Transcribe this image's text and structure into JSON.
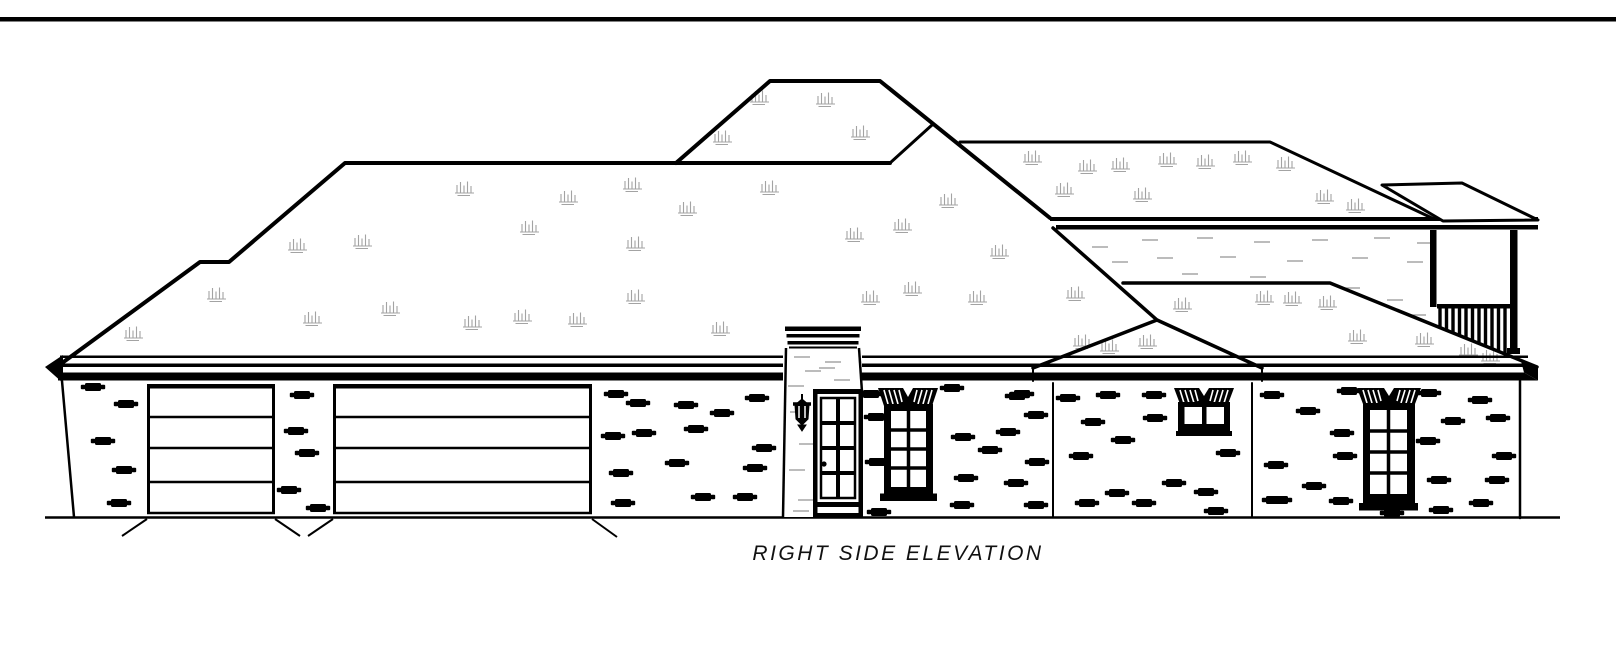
{
  "title": {
    "text": "RIGHT SIDE ELEVATION"
  },
  "colors": {
    "line": "#000000",
    "roof_texture": "#a3a3a3",
    "stucco": "#8f8f8f",
    "paper": "#ffffff"
  },
  "drawing": {
    "kind": "architectural side elevation, black ink on white",
    "roof_texture_marks": [
      [
        133,
        333
      ],
      [
        216,
        294
      ],
      [
        297,
        245
      ],
      [
        362,
        241
      ],
      [
        312,
        318
      ],
      [
        390,
        308
      ],
      [
        464,
        188
      ],
      [
        472,
        322
      ],
      [
        522,
        316
      ],
      [
        529,
        227
      ],
      [
        568,
        197
      ],
      [
        577,
        319
      ],
      [
        632,
        184
      ],
      [
        635,
        243
      ],
      [
        635,
        296
      ],
      [
        687,
        208
      ],
      [
        720,
        328
      ],
      [
        759,
        97
      ],
      [
        769,
        187
      ],
      [
        825,
        99
      ],
      [
        722,
        137
      ],
      [
        860,
        132
      ],
      [
        854,
        234
      ],
      [
        870,
        297
      ],
      [
        902,
        225
      ],
      [
        912,
        288
      ],
      [
        977,
        297
      ],
      [
        999,
        251
      ],
      [
        948,
        200
      ],
      [
        1032,
        157
      ],
      [
        1087,
        166
      ],
      [
        1120,
        164
      ],
      [
        1167,
        159
      ],
      [
        1205,
        161
      ],
      [
        1242,
        157
      ],
      [
        1064,
        189
      ],
      [
        1142,
        194
      ],
      [
        1285,
        163
      ],
      [
        1324,
        196
      ],
      [
        1355,
        205
      ],
      [
        1292,
        298
      ],
      [
        1075,
        293
      ],
      [
        1182,
        304
      ],
      [
        1264,
        297
      ],
      [
        1327,
        302
      ],
      [
        1109,
        346
      ],
      [
        1147,
        341
      ],
      [
        1357,
        336
      ],
      [
        1424,
        339
      ],
      [
        1082,
        341
      ],
      [
        1468,
        350
      ],
      [
        1490,
        356
      ]
    ],
    "brick_marks": [
      [
        93,
        387
      ],
      [
        126,
        404
      ],
      [
        103,
        441
      ],
      [
        124,
        470
      ],
      [
        119,
        503
      ],
      [
        302,
        395
      ],
      [
        296,
        431
      ],
      [
        307,
        453
      ],
      [
        289,
        490
      ],
      [
        318,
        508
      ],
      [
        616,
        394
      ],
      [
        638,
        403
      ],
      [
        686,
        405
      ],
      [
        722,
        413
      ],
      [
        757,
        398
      ],
      [
        613,
        436
      ],
      [
        644,
        433
      ],
      [
        696,
        429
      ],
      [
        764,
        448
      ],
      [
        677,
        463
      ],
      [
        755,
        468
      ],
      [
        621,
        473
      ],
      [
        703,
        497
      ],
      [
        745,
        497
      ],
      [
        623,
        503
      ],
      [
        871,
        394
      ],
      [
        876,
        417
      ],
      [
        877,
        462
      ],
      [
        879,
        512
      ],
      [
        952,
        388
      ],
      [
        1017,
        396
      ],
      [
        963,
        437
      ],
      [
        1008,
        432
      ],
      [
        1036,
        415
      ],
      [
        966,
        478
      ],
      [
        1016,
        483
      ],
      [
        1037,
        462
      ],
      [
        962,
        505
      ],
      [
        1036,
        505
      ],
      [
        990,
        450
      ],
      [
        1022,
        394
      ],
      [
        1068,
        398
      ],
      [
        1108,
        395
      ],
      [
        1154,
        395
      ],
      [
        1093,
        422
      ],
      [
        1155,
        418
      ],
      [
        1123,
        440
      ],
      [
        1081,
        456
      ],
      [
        1228,
        453
      ],
      [
        1174,
        483
      ],
      [
        1206,
        492
      ],
      [
        1087,
        503
      ],
      [
        1117,
        493
      ],
      [
        1144,
        503
      ],
      [
        1216,
        511
      ],
      [
        1272,
        395
      ],
      [
        1276,
        465
      ],
      [
        1274,
        500
      ],
      [
        1308,
        411
      ],
      [
        1342,
        433
      ],
      [
        1345,
        456
      ],
      [
        1341,
        501
      ],
      [
        1280,
        500
      ],
      [
        1349,
        391
      ],
      [
        1314,
        486
      ],
      [
        1429,
        393
      ],
      [
        1480,
        400
      ],
      [
        1498,
        418
      ],
      [
        1453,
        421
      ],
      [
        1428,
        441
      ],
      [
        1504,
        456
      ],
      [
        1439,
        480
      ],
      [
        1497,
        480
      ],
      [
        1481,
        503
      ],
      [
        1441,
        510
      ],
      [
        1392,
        513
      ]
    ],
    "stucco_marks_upper_wall": [
      [
        1100,
        247
      ],
      [
        1150,
        240
      ],
      [
        1205,
        238
      ],
      [
        1262,
        242
      ],
      [
        1320,
        240
      ],
      [
        1382,
        238
      ],
      [
        1425,
        243
      ],
      [
        1165,
        258
      ],
      [
        1228,
        257
      ],
      [
        1295,
        261
      ],
      [
        1360,
        258
      ],
      [
        1415,
        262
      ],
      [
        1190,
        274
      ],
      [
        1258,
        277
      ],
      [
        1352,
        288
      ],
      [
        1395,
        300
      ],
      [
        1418,
        315
      ],
      [
        1120,
        262
      ]
    ],
    "stucco_marks_chimney": [
      [
        802,
        357
      ],
      [
        833,
        362
      ],
      [
        813,
        371
      ],
      [
        842,
        380
      ],
      [
        796,
        386
      ],
      [
        827,
        368
      ],
      [
        798,
        412
      ],
      [
        807,
        444
      ],
      [
        797,
        470
      ],
      [
        806,
        500
      ],
      [
        801,
        511
      ]
    ],
    "garage": {
      "top": 384,
      "bottom": 513,
      "panel_lines": [
        417,
        448,
        482
      ],
      "openings": [
        {
          "x1": 147,
          "x2": 275
        },
        {
          "x1": 333,
          "x2": 592
        }
      ]
    },
    "porch_railing": {
      "x1": 1440,
      "x2": 1509,
      "step": 6.5,
      "top": 308.5,
      "clip": {
        "x0": 1330,
        "y0": 282,
        "slope": 0.411
      }
    }
  }
}
